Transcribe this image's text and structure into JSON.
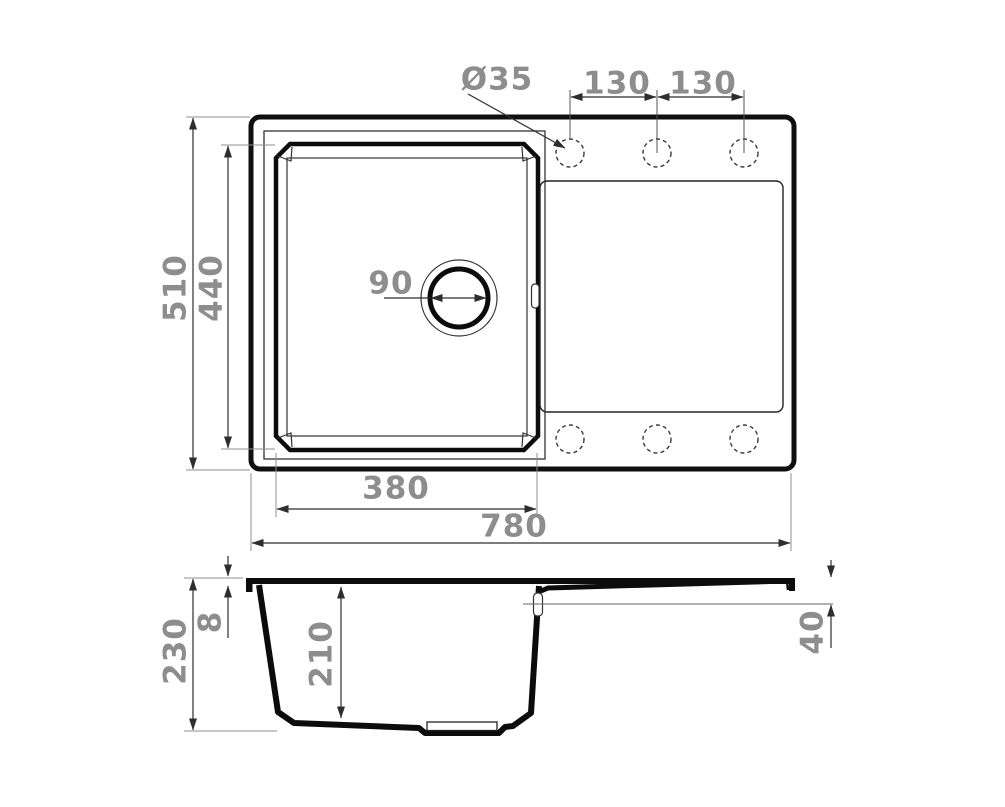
{
  "drawing": {
    "subject": "sink-dimensional-drawing",
    "colors": {
      "outline": "#0f0f0f",
      "thin_line": "#333333",
      "dimension_line": "#2e2e2e",
      "extension_line": "#8f8f8f",
      "label_text": "#8d8d8d",
      "background": "#ffffff"
    },
    "dimensions": {
      "faucet_hole_diameter": "Ø35",
      "hole_spacing_left": "130",
      "hole_spacing_right": "130",
      "overall_width": "510",
      "bowl_inner_width": "440",
      "drain_diameter": "90",
      "bowl_outer_length": "380",
      "overall_length": "780",
      "overall_depth": "230",
      "rim_thickness": "8",
      "bowl_depth": "210",
      "drainboard_drop": "40"
    }
  }
}
